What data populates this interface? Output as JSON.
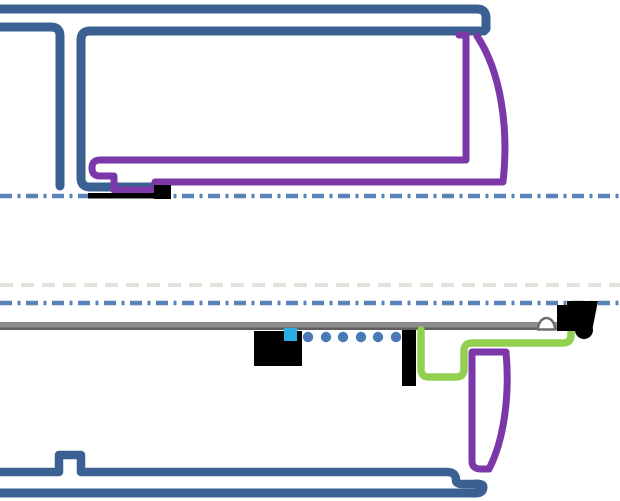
{
  "canvas": {
    "width": 620,
    "height": 501,
    "background": "#ffffff"
  },
  "colors": {
    "structure_blue": "#3a6191",
    "centerline_blue": "#5a84b8",
    "ghost_dash": "#dfe5da",
    "seal_purple": "#7c37a8",
    "gasket_green": "#92d050",
    "rail_gray": "#8d8d8d",
    "rail_gray_dark": "#5f5f5f",
    "marker_cyan": "#2aade4",
    "dot_blue": "#4a79b8",
    "hardware_black": "#000000",
    "dome_outline_gray": "#6e6e6e",
    "dome_fill": "#ffffff"
  },
  "shapes": [
    {
      "name": "ghost-dashed-line",
      "tag": "path",
      "attrs": {
        "d": "M 0,285 H 620",
        "stroke": "#dfe5da",
        "stroke-width": "4",
        "fill": "none",
        "stroke-dasharray": "13 8"
      }
    },
    {
      "name": "centerline-upper",
      "tag": "path",
      "attrs": {
        "d": "M 0,196 H 620",
        "stroke": "#5a84b8",
        "stroke-width": "4.5",
        "fill": "none",
        "stroke-dasharray": "12 5.5 3 5.5"
      }
    },
    {
      "name": "centerline-lower",
      "tag": "path",
      "attrs": {
        "d": "M 0,303 H 620",
        "stroke": "#5a84b8",
        "stroke-width": "4.5",
        "fill": "none",
        "stroke-dasharray": "12 5.5 3 5.5"
      }
    },
    {
      "name": "top-rail-outline",
      "tag": "path",
      "attrs": {
        "d": "M 0,9 H 477 Q 486,9 486,18 V 29",
        "stroke": "#3a6191",
        "stroke-width": "9",
        "fill": "none",
        "stroke-linecap": "round",
        "stroke-linejoin": "round"
      }
    },
    {
      "name": "left-panel-outline",
      "tag": "path",
      "attrs": {
        "d": "M 0,27 H 51 Q 60,27 60,36 V 186",
        "stroke": "#3a6191",
        "stroke-width": "9",
        "fill": "none",
        "stroke-linecap": "round",
        "stroke-linejoin": "round"
      }
    },
    {
      "name": "inner-panel-outline",
      "tag": "path",
      "attrs": {
        "d": "M 484,31 H 90 Q 81,31 81,40 V 178 Q 81,187 90,187 H 157",
        "stroke": "#3a6191",
        "stroke-width": "9",
        "fill": "none",
        "stroke-linecap": "round",
        "stroke-linejoin": "round"
      }
    },
    {
      "name": "upper-seal-outline",
      "tag": "path",
      "attrs": {
        "d": "M 459,35 L 466,35 L 466,160 L 100,160 Q 92,160 92,168 Q 92,176 100,176 L 114,176 L 114,190 L 155,190 L 155,182 L 503,182 C 509,128 501,72 477,36",
        "stroke": "#7c37a8",
        "stroke-width": "7",
        "fill": "none",
        "stroke-linecap": "round",
        "stroke-linejoin": "round"
      }
    },
    {
      "name": "upper-gasket-strip",
      "tag": "rect",
      "attrs": {
        "x": "88",
        "y": "193",
        "width": "69",
        "height": "5.5",
        "fill": "#000000"
      }
    },
    {
      "name": "upper-hardware-block",
      "tag": "rect",
      "attrs": {
        "x": "154",
        "y": "185",
        "width": "17",
        "height": "14",
        "fill": "#000000"
      }
    },
    {
      "name": "bottom-panel-upper-edge",
      "tag": "path",
      "attrs": {
        "d": "M 0,472 H 59 V 455 H 81 V 472 H 447 Q 456,472 456,480 Q 456,484 462,484 H 476",
        "stroke": "#3a6191",
        "stroke-width": "8.5",
        "fill": "none",
        "stroke-linecap": "round",
        "stroke-linejoin": "round"
      }
    },
    {
      "name": "bottom-panel-bar",
      "tag": "path",
      "attrs": {
        "d": "M 0,493 H 476 Q 483,493 483,487 Q 483,484 476,484",
        "stroke": "#3a6191",
        "stroke-width": "9",
        "fill": "none",
        "stroke-linecap": "round",
        "stroke-linejoin": "round"
      }
    },
    {
      "name": "gray-rail",
      "tag": "rect",
      "attrs": {
        "x": "0",
        "y": "322",
        "width": "592",
        "height": "8",
        "fill": "#8d8d8d"
      }
    },
    {
      "name": "gray-rail-shadow-edge",
      "tag": "rect",
      "attrs": {
        "x": "0",
        "y": "327.5",
        "width": "592",
        "height": "2.5",
        "fill": "#5f5f5f"
      }
    },
    {
      "name": "roller-dome",
      "tag": "path",
      "attrs": {
        "d": "M 538,329.5 A 8.5 11.5 0 0 1 555,329.5 Z",
        "fill": "#ffffff",
        "stroke": "#6e6e6e",
        "stroke-width": "2.5",
        "stroke-linejoin": "round"
      }
    },
    {
      "name": "fastener-dot-1",
      "tag": "circle",
      "attrs": {
        "cx": "308",
        "cy": "337",
        "r": "5.2",
        "fill": "#4a79b8"
      }
    },
    {
      "name": "fastener-dot-2",
      "tag": "circle",
      "attrs": {
        "cx": "326",
        "cy": "337",
        "r": "5.2",
        "fill": "#4a79b8"
      }
    },
    {
      "name": "fastener-dot-3",
      "tag": "circle",
      "attrs": {
        "cx": "343",
        "cy": "337",
        "r": "5.2",
        "fill": "#4a79b8"
      }
    },
    {
      "name": "fastener-dot-4",
      "tag": "circle",
      "attrs": {
        "cx": "361",
        "cy": "337",
        "r": "5.2",
        "fill": "#4a79b8"
      }
    },
    {
      "name": "fastener-dot-5",
      "tag": "circle",
      "attrs": {
        "cx": "378",
        "cy": "337",
        "r": "5.2",
        "fill": "#4a79b8"
      }
    },
    {
      "name": "fastener-dot-6",
      "tag": "circle",
      "attrs": {
        "cx": "396",
        "cy": "337",
        "r": "5.2",
        "fill": "#4a79b8"
      }
    },
    {
      "name": "mid-hardware-block",
      "tag": "rect",
      "attrs": {
        "x": "254",
        "y": "331",
        "width": "48",
        "height": "35",
        "fill": "#000000"
      }
    },
    {
      "name": "cyan-marker-square",
      "tag": "rect",
      "attrs": {
        "x": "284",
        "y": "328",
        "width": "13",
        "height": "13",
        "fill": "#2aade4"
      }
    },
    {
      "name": "vertical-hardware-bar",
      "tag": "rect",
      "attrs": {
        "x": "402",
        "y": "330",
        "width": "14",
        "height": "56",
        "fill": "#000000"
      }
    },
    {
      "name": "green-gasket-path",
      "tag": "path",
      "attrs": {
        "d": "M 421,330 V 369 Q 421,377 429,377 H 456 Q 464,377 464,369 V 351 Q 464,343 472,343 H 563 Q 571,343 571,335 V 329",
        "stroke": "#92d050",
        "stroke-width": "7.5",
        "fill": "none",
        "stroke-linecap": "round",
        "stroke-linejoin": "round"
      }
    },
    {
      "name": "lower-seal-outline",
      "tag": "path",
      "attrs": {
        "d": "M 472,352 H 506 C 510,395 504,440 489,469 H 481 Q 472,469 472,461 Z",
        "stroke": "#7c37a8",
        "stroke-width": "7",
        "fill": "none",
        "stroke-linecap": "round",
        "stroke-linejoin": "round"
      }
    },
    {
      "name": "right-hardware-block",
      "tag": "polygon",
      "attrs": {
        "points": "557,331 557,305 567,305 567,301 598,301 592,331",
        "fill": "#000000"
      }
    },
    {
      "name": "right-hardware-roller",
      "tag": "circle",
      "attrs": {
        "cx": "584",
        "cy": "330",
        "r": "9",
        "fill": "#000000"
      }
    }
  ]
}
